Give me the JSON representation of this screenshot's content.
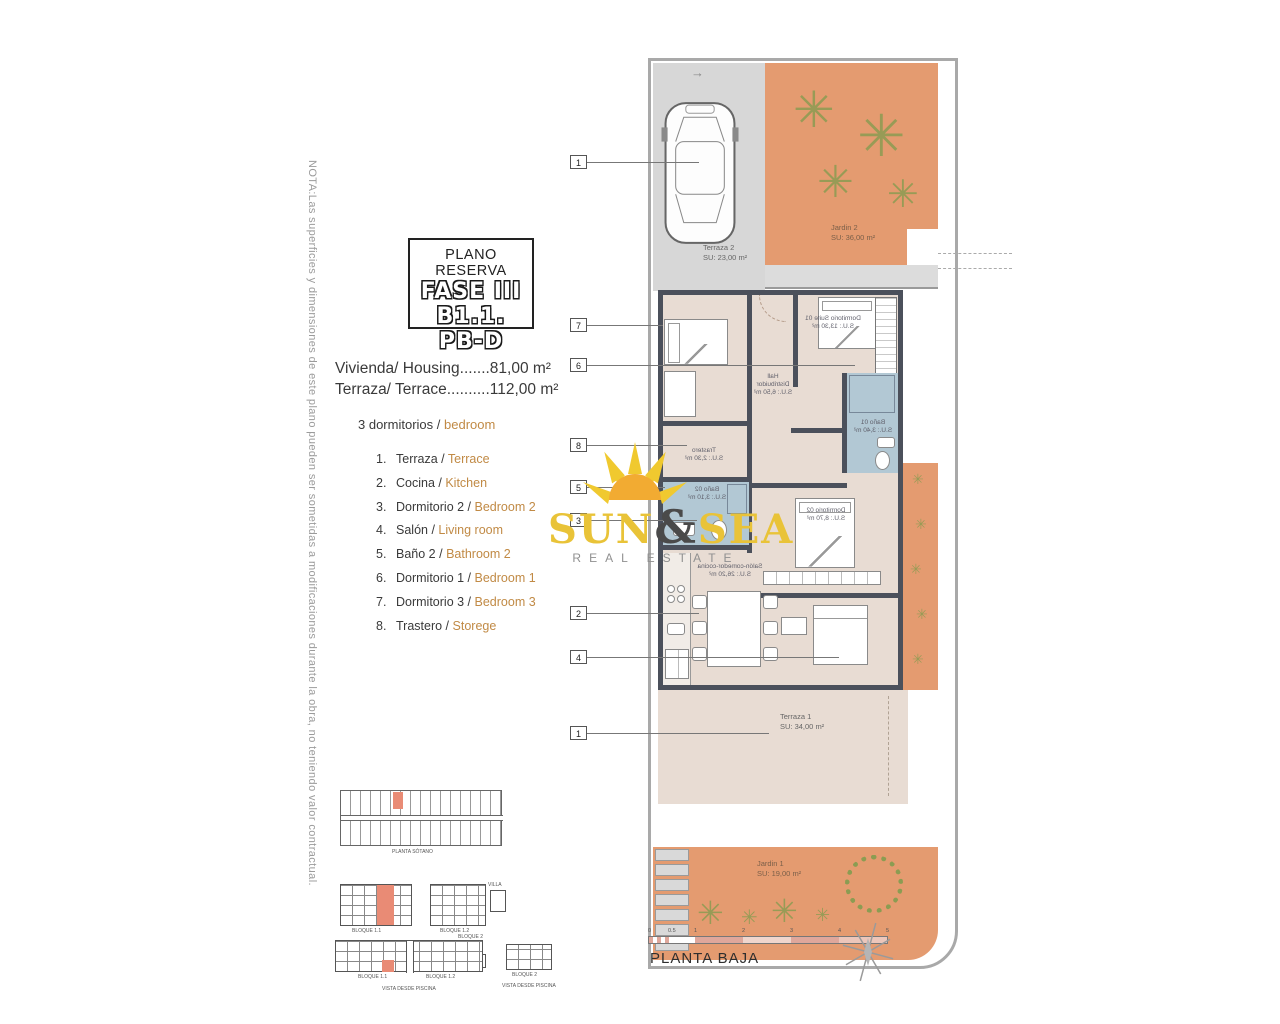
{
  "note_vertical": "NOTA:Las superficies y dimensiones de este plano pueden ser sometidas a modificaciones durante la obra, no teniendo valor contractual.",
  "title_box": {
    "line1": "PLANO RESERVA",
    "line2": "FASE III",
    "line3": "B1.1. PB-D"
  },
  "areas": {
    "housing": "Vivienda/ Housing.......81,00 m²",
    "terrace": "Terraza/ Terrace..........112,00 m²"
  },
  "bedrooms": {
    "es": "3 dormitorios /",
    "en": "bedroom"
  },
  "legend": [
    {
      "num": "1.",
      "es": "Terraza /",
      "en": "Terrace"
    },
    {
      "num": "2.",
      "es": "Cocina /",
      "en": "Kitchen"
    },
    {
      "num": "3.",
      "es": "Dormitorio 2 /",
      "en": "Bedroom 2"
    },
    {
      "num": "4.",
      "es": "Salón /",
      "en": "Living room"
    },
    {
      "num": "5.",
      "es": "Baño 2 /",
      "en": "Bathroom 2"
    },
    {
      "num": "6.",
      "es": "Dormitorio 1 /",
      "en": "Bedroom 1"
    },
    {
      "num": "7.",
      "es": "Dormitorio 3 /",
      "en": "Bedroom 3"
    },
    {
      "num": "8.",
      "es": "Trastero /",
      "en": "Storege"
    }
  ],
  "watermark": {
    "word1": "SUN",
    "amp": "&",
    "word2": "SEA",
    "subtitle": "REAL ESTATE"
  },
  "plan": {
    "rooms": {
      "terraza2": {
        "name": "Terraza 2",
        "area": "SU: 23,00 m²"
      },
      "jardin2": {
        "name": "Jardin 2",
        "area": "SU: 36,00 m²"
      },
      "suite": {
        "name": "Dormitorio Suite 01",
        "area": "S.U.: 13,30 m²"
      },
      "hall": {
        "name": "Hall",
        "name2": "Distribuidor",
        "area": "S.U.: 6,50 m²"
      },
      "trastero": {
        "name": "Trastero",
        "area": "S.U.: 2,30 m²"
      },
      "bano1": {
        "name": "Baño 01",
        "area": "S.U.: 3,40 m²"
      },
      "bano2": {
        "name": "Baño 02",
        "area": "S.U.: 3,10 m²"
      },
      "dorm2": {
        "name": "Dormitorio 02",
        "area": "S.U.: 8,70 m²"
      },
      "salon": {
        "name": "Salón-comedor-cocina",
        "area": "S.U.: 26,20 m²"
      },
      "terraza1": {
        "name": "Terraza 1",
        "area": "SU: 34,00 m²"
      },
      "jardin1": {
        "name": "Jardin 1",
        "area": "SU: 19,00 m²"
      }
    },
    "callouts": [
      "1",
      "7",
      "6",
      "8",
      "5",
      "3",
      "2",
      "4",
      "1"
    ],
    "scale": [
      "0",
      "0.5",
      "1",
      "2",
      "3",
      "4",
      "5"
    ],
    "floor_label": "PLANTA BAJA"
  },
  "miniplans": {
    "sotano": "PLANTA SÓTANO",
    "bloque11": "BLOQUE 1.1",
    "bloque12": "BLOQUE 1.2",
    "bloque2": "BLOQUE 2",
    "piscina": "PISCINA",
    "villa": "VILLA",
    "vista": "VISTA DESDE PISCINA"
  },
  "icons": {
    "arrow": "→",
    "plant": "✳"
  },
  "colors": {
    "garden_orange": "#e49b70",
    "floor_beige": "#e8dcd3",
    "wall_dark": "#4b505b",
    "bath_blue": "#b2c8d4",
    "parking_gray": "#d7d7d7",
    "watermark_yellow": "#e9c338",
    "legend_orange": "#c18a45",
    "scale_salmon": "#dfa79b",
    "highlight_red": "#e98b75",
    "plant_green": "#8b9c52"
  }
}
